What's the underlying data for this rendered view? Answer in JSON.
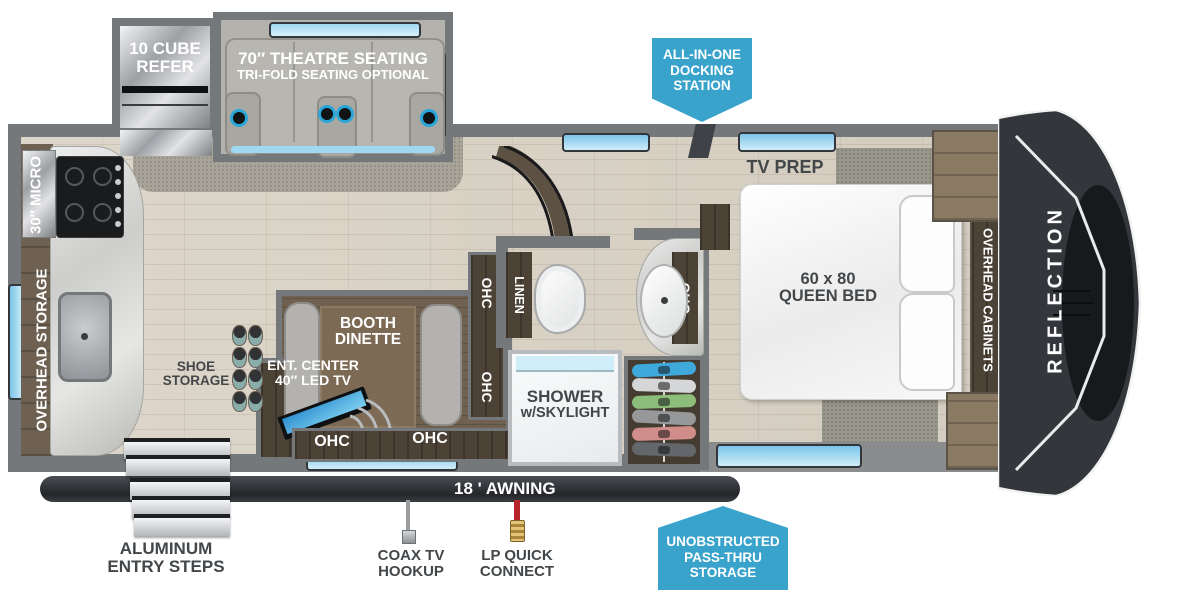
{
  "colors": {
    "accent_blue": "#3aa3cc",
    "window_blue": "#9fd8f2",
    "wall_gray": "#75787b",
    "awning_dark": "#2c2f33",
    "label_dark": "#43474a"
  },
  "callouts": {
    "docking_line1": "ALL-IN-ONE",
    "docking_line2": "DOCKING",
    "docking_line3": "STATION",
    "passthru_line1": "UNOBSTRUCTED",
    "passthru_line2": "PASS-THRU",
    "passthru_line3": "STORAGE"
  },
  "slideouts": {
    "refer_line1": "10 CUBE",
    "refer_line2": "REFER",
    "theatre_line1": "70″ THEATRE SEATING",
    "theatre_line2": "TRI-FOLD SEATING OPTIONAL"
  },
  "kitchen": {
    "micro": "30″ MICRO",
    "overhead_storage": "OVERHEAD STORAGE",
    "shoe_line1": "SHOE",
    "shoe_line2": "STORAGE"
  },
  "dinette": {
    "booth_line1": "BOOTH",
    "booth_line2": "DINETTE",
    "ent_line1": "ENT. CENTER",
    "ent_line2": "40″ LED TV",
    "ohc": "OHC"
  },
  "bathroom": {
    "linen": "LINEN",
    "shower_line1": "SHOWER",
    "shower_line2": "w/SKYLIGHT",
    "ohc": "OHC"
  },
  "bedroom": {
    "tv_prep": "TV PREP",
    "bed_line1": "60 x 80",
    "bed_line2": "QUEEN BED",
    "overhead_cabinets": "OVERHEAD CABINETS"
  },
  "exterior": {
    "brand": "REFLECTION",
    "awning": "18 ' AWNING",
    "steps_line1": "ALUMINUM",
    "steps_line2": "ENTRY STEPS",
    "coax_line1": "COAX TV",
    "coax_line2": "HOOKUP",
    "lp_line1": "LP QUICK",
    "lp_line2": "CONNECT"
  }
}
